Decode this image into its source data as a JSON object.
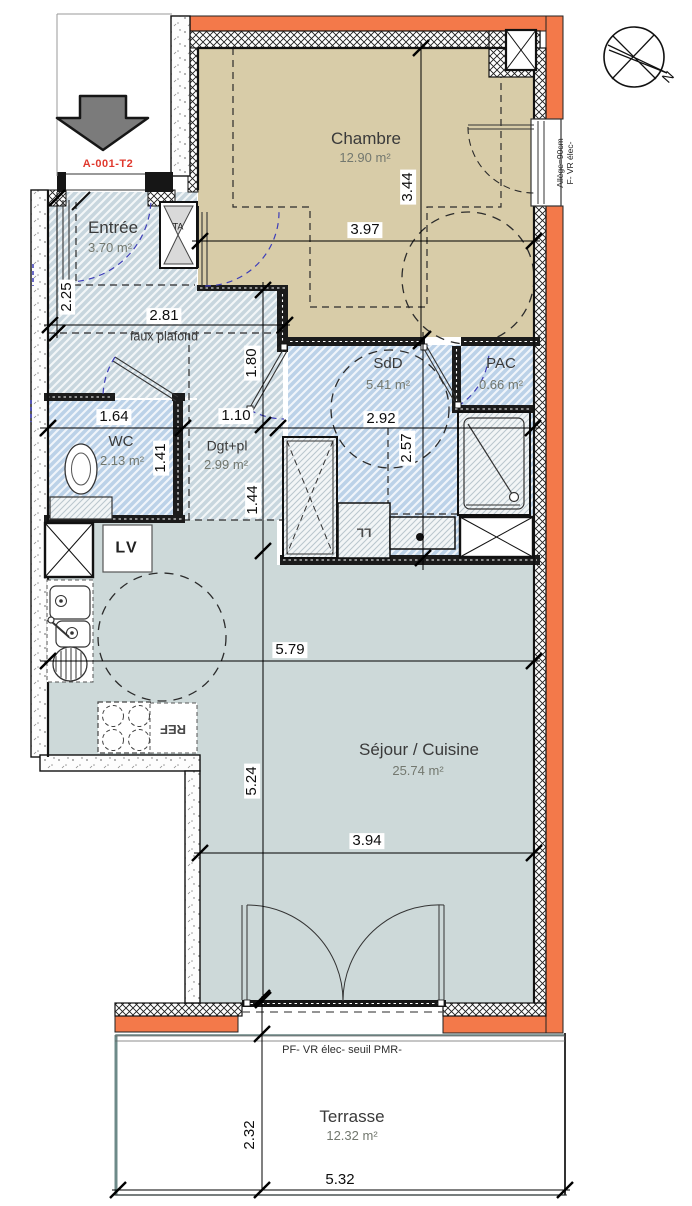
{
  "plan": {
    "unit_label": "A-001-T2",
    "north_label": "N"
  },
  "rooms": {
    "entree": {
      "name": "Entrée",
      "area": "3.70 m²"
    },
    "chambre": {
      "name": "Chambre",
      "area": "12.90 m²"
    },
    "sdd": {
      "name": "SdD",
      "area": "5.41 m²"
    },
    "pac": {
      "name": "PAC",
      "area": "0.66 m²"
    },
    "wc": {
      "name": "WC",
      "area": "2.13 m²"
    },
    "dgt": {
      "name": "Dgt+pl",
      "area": "2.99 m²"
    },
    "sejour": {
      "name": "Séjour / Cuisine",
      "area": "25.74 m²"
    },
    "terrasse": {
      "name": "Terrasse",
      "area": "12.32 m²"
    }
  },
  "annotations": {
    "faux_plafond": "faux plafond",
    "ta": "TA",
    "lv": "LV",
    "ll": "LL",
    "ref": "REF",
    "window_note_line1": "Allège=90cm",
    "window_note_line2": "F- VR élec-",
    "terrace_note": "PF-  VR élec- seuil PMR-"
  },
  "dimensions": {
    "d225": "2.25",
    "d281": "2.81",
    "d180": "1.80",
    "d344": "3.44",
    "d397": "3.97",
    "d164": "1.64",
    "d110": "1.10",
    "d292": "2.92",
    "d141": "1.41",
    "d257": "2.57",
    "d144": "1.44",
    "d579": "5.79",
    "d524": "5.24",
    "d394": "3.94",
    "d232": "2.32",
    "d532": "5.32"
  },
  "colors": {
    "wall_orange": "#F3794A",
    "room_beige": "#D8CCA8",
    "room_blue": "#BCD2E8",
    "circulation_blue": "#C8D6DE",
    "sejour_gray": "#CDD9D9",
    "unit_label_red": "#E0392E",
    "door_swing_blue": "#3D3DB8"
  }
}
